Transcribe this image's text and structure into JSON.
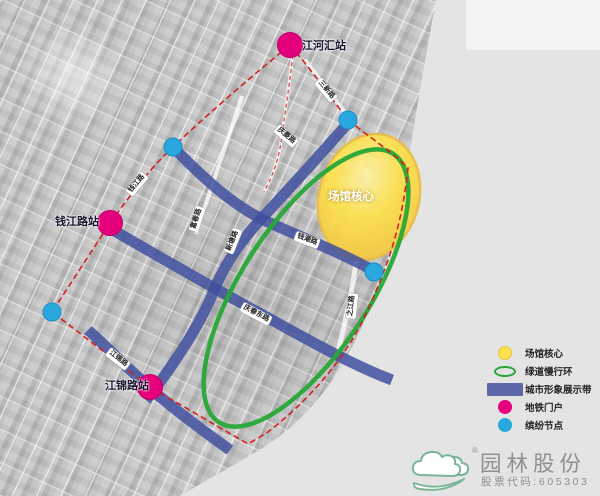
{
  "map": {
    "core_label": "场馆核心",
    "stations": [
      {
        "name": "江河汇站",
        "x": 290,
        "y": 45,
        "label_x": 324,
        "label_y": 45
      },
      {
        "name": "钱江路站",
        "x": 110,
        "y": 223,
        "label_x": 77,
        "label_y": 221
      },
      {
        "name": "江锦路站",
        "x": 150,
        "y": 387,
        "label_x": 127,
        "label_y": 385
      }
    ],
    "nodes": [
      {
        "x": 348,
        "y": 120
      },
      {
        "x": 173,
        "y": 147
      },
      {
        "x": 374,
        "y": 272
      },
      {
        "x": 52,
        "y": 312
      }
    ],
    "roads": [
      {
        "text": "三新路",
        "x": 326,
        "y": 90,
        "rot": 50
      },
      {
        "text": "庆菱路",
        "x": 286,
        "y": 136,
        "rot": 40
      },
      {
        "text": "钱江路",
        "x": 137,
        "y": 184,
        "rot": -50
      },
      {
        "text": "富春路",
        "x": 197,
        "y": 219,
        "rot": -72
      },
      {
        "text": "新塘路",
        "x": 233,
        "y": 241,
        "rot": -68
      },
      {
        "text": "钱潮路",
        "x": 307,
        "y": 240,
        "rot": 20
      },
      {
        "text": "庆春东路",
        "x": 256,
        "y": 314,
        "rot": 28
      },
      {
        "text": "之江路",
        "x": 352,
        "y": 306,
        "rot": -84
      },
      {
        "text": "江锦路",
        "x": 118,
        "y": 359,
        "rot": 38
      }
    ]
  },
  "legend": {
    "items": [
      {
        "swatch": "venue",
        "label": "场馆核心"
      },
      {
        "swatch": "greenway",
        "label": "绿道慢行环"
      },
      {
        "swatch": "belt",
        "label": "城市形象展示带"
      },
      {
        "swatch": "metro",
        "label": "地铁门户"
      },
      {
        "swatch": "node",
        "label": "缤纷节点"
      }
    ]
  },
  "logo": {
    "company": "园林股份",
    "stock": "股票代码:605303",
    "reg": "®"
  },
  "colors": {
    "venue_yellow": "#ffdf4d",
    "greenway_green": "#27a637",
    "belt_blue": "#46519e",
    "metro_pink": "#e5007d",
    "node_cyan": "#29a8e0",
    "boundary_red": "#d42020",
    "water_gray": "#e4e4e4"
  }
}
